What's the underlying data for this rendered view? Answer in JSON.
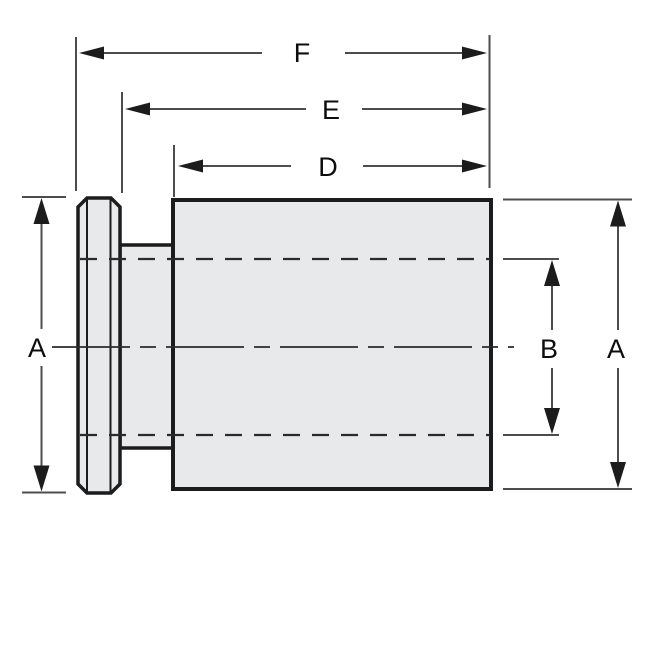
{
  "drawing": {
    "labels": {
      "f": "F",
      "e": "E",
      "d": "D",
      "a_left": "A",
      "b": "B",
      "a_right": "A"
    },
    "colors": {
      "background": "#ffffff",
      "part_fill": "#e8e9ea",
      "part_outline": "#1c1c1c",
      "dimension_line": "#4d4d4d",
      "arrowhead": "#1c1c1c",
      "hidden_line": "#2b2b2b",
      "label_text": "#0d0d0d"
    }
  }
}
